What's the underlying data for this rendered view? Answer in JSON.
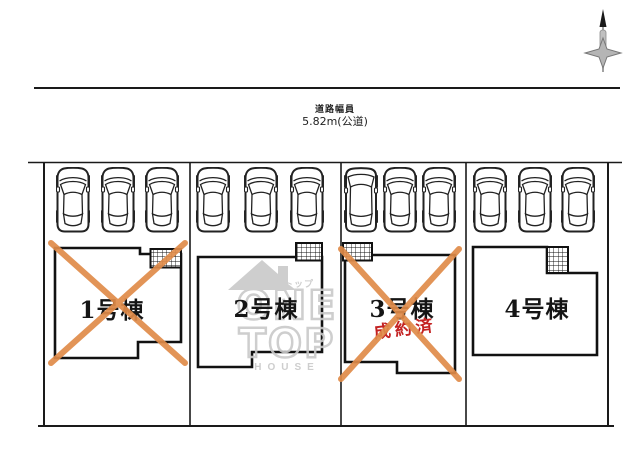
{
  "diagram": {
    "type": "site-plan",
    "road": {
      "name_label": "道路幅員",
      "width_label": "5.82m(公道)"
    },
    "compass": {
      "icon": "north-arrow"
    },
    "lots": {
      "count": 4,
      "cars_per_lot": 3,
      "car_icon": "car-top-view"
    },
    "units": [
      {
        "label": "1号棟",
        "status": "sold",
        "crossed_out": true,
        "stamp": ""
      },
      {
        "label": "2号棟",
        "status": "available",
        "crossed_out": false,
        "stamp": ""
      },
      {
        "label": "3号棟",
        "status": "sold",
        "crossed_out": true,
        "stamp": "成約済"
      },
      {
        "label": "4号棟",
        "status": "available",
        "crossed_out": false,
        "stamp": ""
      }
    ],
    "watermark": {
      "company_katakana": "ワントップ",
      "logo_word1": "ONE",
      "logo_word2": "TOP",
      "logo_word3": "HOUSE",
      "roof_icon": "house-roof"
    },
    "colors": {
      "outline": "#1a1a1a",
      "cross_orange": "#e08b49",
      "stamp_red": "#c32222",
      "watermark_gray": "#c9c9c9",
      "compass_gray": "#9a9a9a"
    }
  }
}
